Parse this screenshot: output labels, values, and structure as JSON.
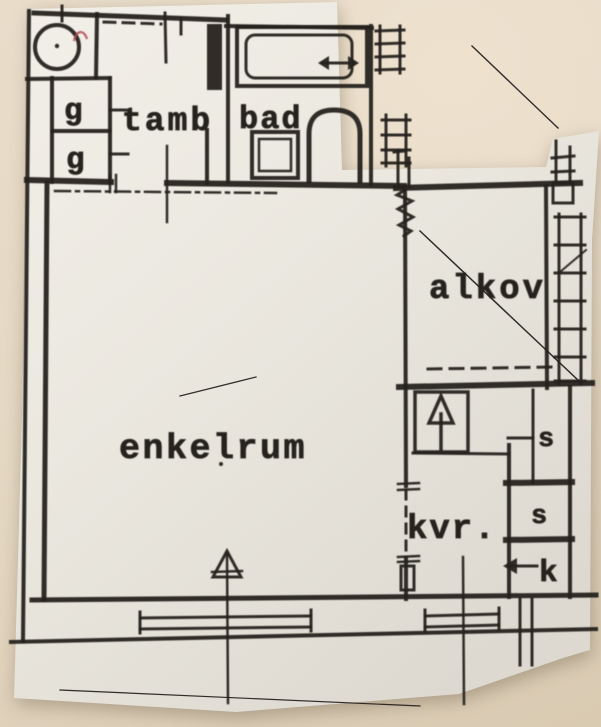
{
  "scene": {
    "type": "photographed paper floor plan",
    "background_color": "#e7dbc7",
    "paper_color": "#eeebe3",
    "ink_color": "#26221d",
    "pen_mark_color": "#b44a54"
  },
  "floor_plan": {
    "rooms": [
      {
        "id": "tamb",
        "label": "tamb"
      },
      {
        "id": "bad",
        "label": "bad"
      },
      {
        "id": "alkov",
        "label": "alkov"
      },
      {
        "id": "enkelrum",
        "label": "enkelrum"
      },
      {
        "id": "kvr",
        "label": "kvr."
      }
    ],
    "storage": {
      "wardrobe_upper": "g",
      "wardrobe_lower": "g",
      "cabinet_upper": "s",
      "cabinet_lower": "s",
      "fridge": "k"
    },
    "icons": [
      "boiler-circle-icon",
      "entrance-door-icon",
      "bathtub-icon",
      "washbasin-icon",
      "toilet-icon",
      "shaft-ladder-icon",
      "radiator-ladder-icon",
      "stove-arrow-icon",
      "window-icon",
      "north-arrow-icon",
      "fridge-arrow-icon"
    ]
  }
}
